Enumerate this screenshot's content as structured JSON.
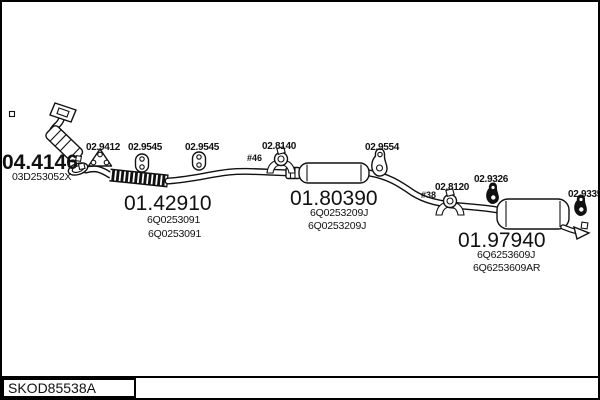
{
  "diagram": {
    "drawing_code": "SKOD85538A",
    "parts": {
      "catalyst": {
        "ref": "04.4146",
        "oe_codes": [
          "03D253052X"
        ]
      },
      "front_pipe": {
        "ref": "01.42910",
        "oe_codes": [
          "6Q0253091",
          "6Q0253091"
        ]
      },
      "centre_silencer": {
        "ref": "01.80390",
        "oe_codes": [
          "6Q0253209J",
          "6Q0253209J"
        ]
      },
      "rear_silencer": {
        "ref": "01.97940",
        "oe_codes": [
          "6Q6253609J",
          "6Q6253609AR"
        ]
      }
    },
    "mountings": {
      "bracket_1": "02.9412",
      "hanger_1": "02.9545",
      "hanger_2": "02.9545",
      "clamp_1": "02.8140",
      "clamp_1_size": "#46",
      "hanger_3": "02.9554",
      "clamp_2": "02.8120",
      "clamp_2_size": "#38",
      "hanger_4": "02.9326",
      "hanger_5": "02.9335"
    },
    "colors": {
      "ink": "#111111",
      "background": "#ffffff"
    }
  }
}
